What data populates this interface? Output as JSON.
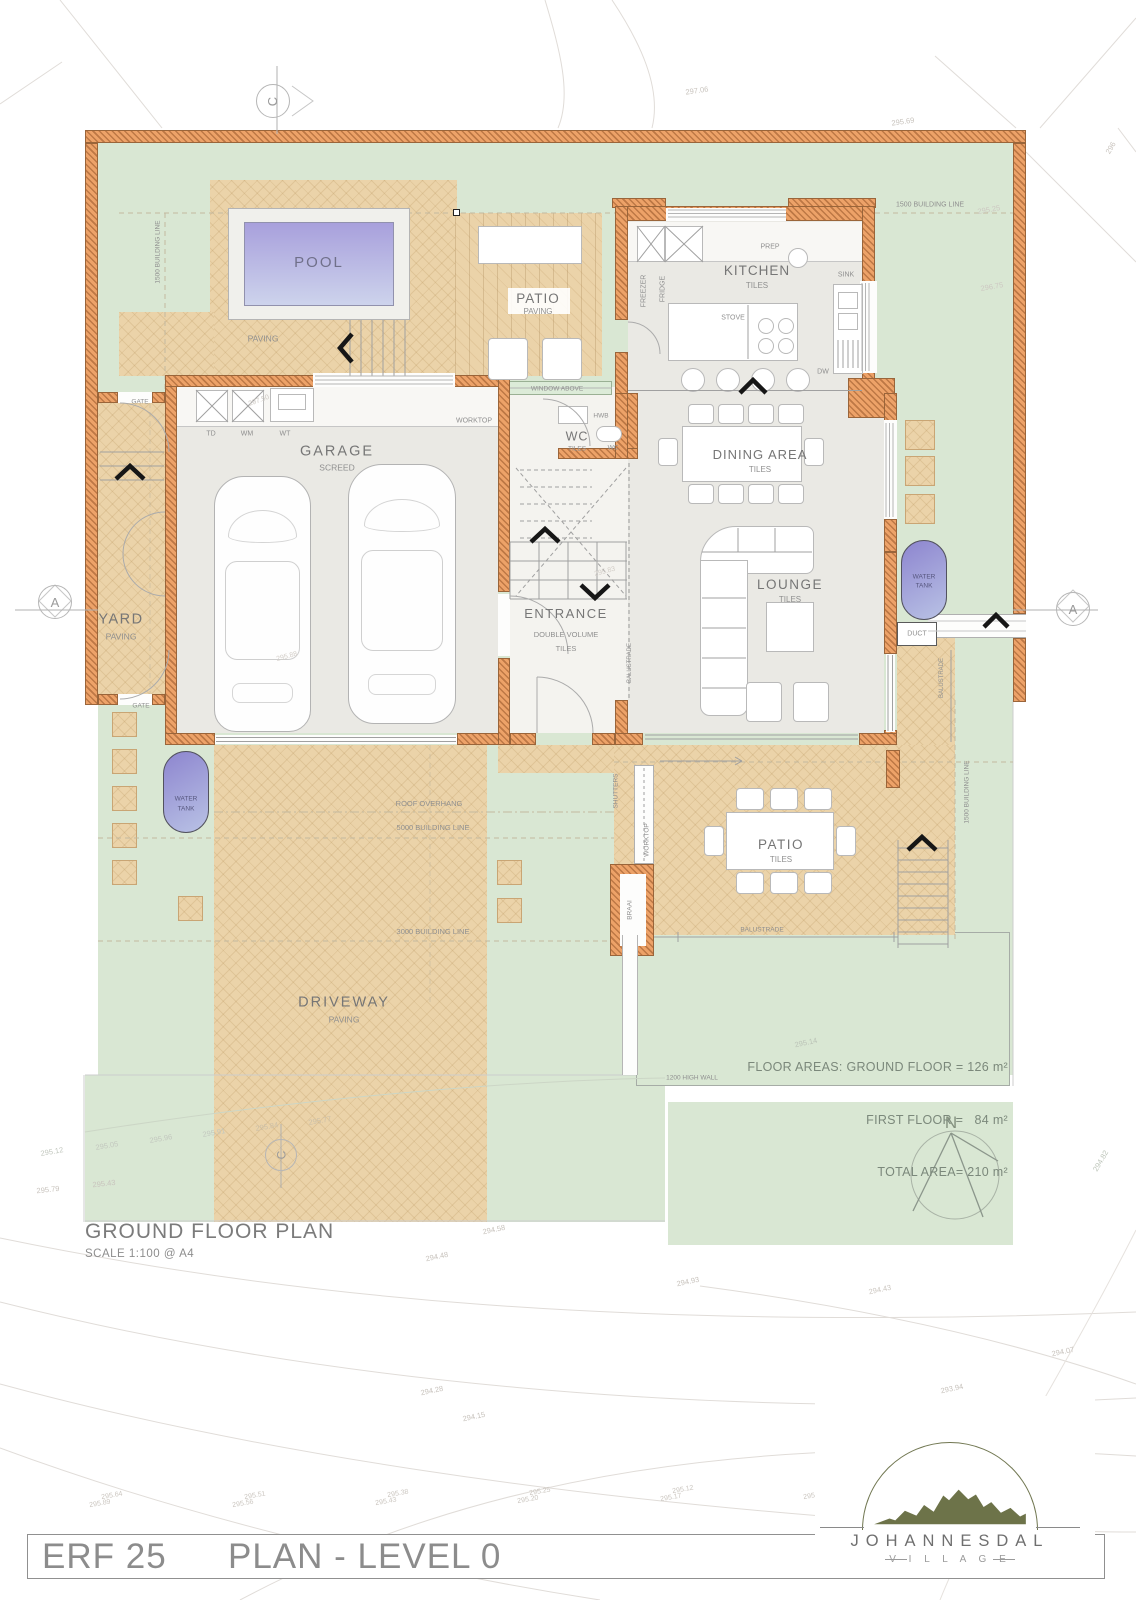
{
  "page": {
    "footer_left": "ERF 25",
    "footer_right": "PLAN - LEVEL 0",
    "plan_title": "GROUND FLOOR PLAN",
    "plan_scale": "SCALE 1:100 @ A4"
  },
  "floor_areas": {
    "line1": "FLOOR AREAS: GROUND FLOOR = 126 m²",
    "line2": "FIRST FLOOR =   84 m²",
    "line3": "TOTAL AREA= 210 m²"
  },
  "logo": {
    "name": "JOHANNESDAL",
    "sub": "V I L L A G E"
  },
  "markers": {
    "c_top": "C",
    "c_bottom": "C",
    "a_left": "A",
    "a_right": "A"
  },
  "compass": {
    "north": "N"
  },
  "colors": {
    "wall": "#eda268",
    "lawn": "#d9e7d3",
    "paving": "#ebd3a9",
    "pool": "#a8a0dc",
    "floor": "#eae9e4"
  },
  "annotations": [
    {
      "t": "POOL",
      "x": 319,
      "y": 263,
      "s": 15,
      "c": "#70708a",
      "l": 2
    },
    {
      "t": "PAVING",
      "x": 263,
      "y": 339,
      "s": 8.5
    },
    {
      "t": "PATIO",
      "x": 538,
      "y": 299,
      "s": 13.5,
      "c": "#767676",
      "l": 1
    },
    {
      "t": "PAVING",
      "x": 538,
      "y": 312,
      "s": 8
    },
    {
      "t": "KITCHEN",
      "x": 757,
      "y": 271,
      "s": 13.5,
      "c": "#767676",
      "l": 1
    },
    {
      "t": "TILES",
      "x": 757,
      "y": 286,
      "s": 8
    },
    {
      "t": "PREP",
      "x": 770,
      "y": 247,
      "s": 7
    },
    {
      "t": "FREEZER",
      "x": 644,
      "y": 291,
      "s": 7,
      "r": -90
    },
    {
      "t": "FRIDGE",
      "x": 663,
      "y": 289,
      "s": 7,
      "r": -90
    },
    {
      "t": "STOVE",
      "x": 733,
      "y": 318,
      "s": 7
    },
    {
      "t": "SINK",
      "x": 846,
      "y": 275,
      "s": 7
    },
    {
      "t": "DW",
      "x": 823,
      "y": 372,
      "s": 7
    },
    {
      "t": "1500 BUILDING LINE",
      "x": 930,
      "y": 205,
      "s": 7
    },
    {
      "t": "GARAGE",
      "x": 337,
      "y": 452,
      "s": 14.5,
      "c": "#767676",
      "l": 2
    },
    {
      "t": "SCREED",
      "x": 337,
      "y": 468,
      "s": 8.5
    },
    {
      "t": "WORKTOP",
      "x": 474,
      "y": 421,
      "s": 7
    },
    {
      "t": "TD",
      "x": 211,
      "y": 434,
      "s": 7
    },
    {
      "t": "WM",
      "x": 247,
      "y": 434,
      "s": 7
    },
    {
      "t": "WT",
      "x": 285,
      "y": 434,
      "s": 7
    },
    {
      "t": "WINDOW ABOVE",
      "x": 557,
      "y": 390,
      "s": 6.5
    },
    {
      "t": "HWB",
      "x": 601,
      "y": 417,
      "s": 6.5
    },
    {
      "t": "WC",
      "x": 577,
      "y": 437,
      "s": 12.5,
      "c": "#767676",
      "l": 1
    },
    {
      "t": "TILES",
      "x": 577,
      "y": 450,
      "s": 6.5
    },
    {
      "t": "WC",
      "x": 613,
      "y": 449,
      "s": 6.5
    },
    {
      "t": "DINING AREA",
      "x": 760,
      "y": 455,
      "s": 13,
      "c": "#767676",
      "l": 1
    },
    {
      "t": "TILES",
      "x": 760,
      "y": 470,
      "s": 8
    },
    {
      "t": "LOUNGE",
      "x": 790,
      "y": 585,
      "s": 13.5,
      "c": "#767676",
      "l": 1.5
    },
    {
      "t": "TILES",
      "x": 790,
      "y": 600,
      "s": 8
    },
    {
      "t": "ENTRANCE",
      "x": 566,
      "y": 614,
      "s": 13,
      "c": "#767676",
      "l": 1.5
    },
    {
      "t": "DOUBLE VOLUME",
      "x": 566,
      "y": 635,
      "s": 7.5
    },
    {
      "t": "TILES",
      "x": 566,
      "y": 649,
      "s": 7.5
    },
    {
      "t": "BALUSTRADE",
      "x": 630,
      "y": 663,
      "s": 6,
      "r": -90
    },
    {
      "t": "BALUSTRADE",
      "x": 942,
      "y": 678,
      "s": 6,
      "r": -90
    },
    {
      "t": "WATER",
      "x": 924,
      "y": 578,
      "s": 6.5,
      "c": "#56567e"
    },
    {
      "t": "TANK",
      "x": 924,
      "y": 587,
      "s": 6.5,
      "c": "#56567e"
    },
    {
      "t": "WATER",
      "x": 186,
      "y": 800,
      "s": 6.5,
      "c": "#56567e"
    },
    {
      "t": "TANK",
      "x": 186,
      "y": 810,
      "s": 6.5,
      "c": "#56567e"
    },
    {
      "t": "DUCT",
      "x": 917,
      "y": 634,
      "s": 7
    },
    {
      "t": "YARD",
      "x": 121,
      "y": 620,
      "s": 14.5,
      "c": "#767676",
      "l": 1.5
    },
    {
      "t": "PAVING",
      "x": 121,
      "y": 637,
      "s": 8.5
    },
    {
      "t": "GATE",
      "x": 140,
      "y": 403,
      "s": 6.5
    },
    {
      "t": "GATE",
      "x": 141,
      "y": 707,
      "s": 6.5
    },
    {
      "t": "1500 BUILDING LINE",
      "x": 159,
      "y": 252,
      "s": 6.5,
      "r": -90
    },
    {
      "t": "SHUTTERS",
      "x": 617,
      "y": 791,
      "s": 6.5,
      "r": -90
    },
    {
      "t": "WORKTOP",
      "x": 648,
      "y": 840,
      "s": 6.5,
      "r": -90
    },
    {
      "t": "BRAAI",
      "x": 631,
      "y": 910,
      "s": 6.5,
      "r": -90
    },
    {
      "t": "PATIO",
      "x": 781,
      "y": 845,
      "s": 13.5,
      "c": "#767676",
      "l": 1.5
    },
    {
      "t": "TILES",
      "x": 781,
      "y": 860,
      "s": 8
    },
    {
      "t": "BALUSTRADE",
      "x": 762,
      "y": 931,
      "s": 6.5
    },
    {
      "t": "1500 BUILDING LINE",
      "x": 968,
      "y": 792,
      "s": 6.5,
      "r": -90
    },
    {
      "t": "ROOF OVERHANG",
      "x": 429,
      "y": 804,
      "s": 7.5
    },
    {
      "t": "5000 BUILDING LINE",
      "x": 433,
      "y": 828,
      "s": 7.5
    },
    {
      "t": "3000 BUILDING LINE",
      "x": 433,
      "y": 932,
      "s": 7.5
    },
    {
      "t": "DRIVEWAY",
      "x": 344,
      "y": 1003,
      "s": 14.5,
      "c": "#767676",
      "l": 2
    },
    {
      "t": "PAVING",
      "x": 344,
      "y": 1020,
      "s": 8.5
    },
    {
      "t": "1200 HIGH WALL",
      "x": 692,
      "y": 1079,
      "s": 6.5
    },
    {
      "t": "N",
      "x": 951,
      "y": 1123,
      "s": 17,
      "c": "#84917f"
    },
    {
      "t": "297.06",
      "x": 697,
      "y": 91,
      "s": 7.5,
      "c": "#c8c3bd",
      "r": -8
    },
    {
      "t": "295.69",
      "x": 903,
      "y": 122,
      "s": 7.5,
      "c": "#c8c3bd",
      "r": -8
    },
    {
      "t": "295.25",
      "x": 989,
      "y": 210,
      "s": 7.5,
      "c": "#cdc8c2",
      "r": -10
    },
    {
      "t": "296.75",
      "x": 992,
      "y": 287,
      "s": 7.5,
      "c": "#cdc8c2",
      "r": -10
    },
    {
      "t": "296",
      "x": 1111,
      "y": 148,
      "s": 7.5,
      "c": "#c8c3bd",
      "r": -60
    },
    {
      "t": "297.50",
      "x": 259,
      "y": 401,
      "s": 7,
      "c": "#cdc8c2",
      "r": -20
    },
    {
      "t": "295.88",
      "x": 287,
      "y": 657,
      "s": 7,
      "c": "#d2cdc7",
      "r": -15
    },
    {
      "t": "295.83",
      "x": 605,
      "y": 572,
      "s": 7,
      "c": "#d2cdc7",
      "r": -15
    },
    {
      "t": "295.14",
      "x": 806,
      "y": 1043,
      "s": 7.5,
      "c": "#bcc4b8",
      "r": -12
    },
    {
      "t": "295.12",
      "x": 52,
      "y": 1152,
      "s": 7.5,
      "c": "#c3c8bf",
      "r": -10
    },
    {
      "t": "295.05",
      "x": 107,
      "y": 1146,
      "s": 7.5,
      "c": "#c3c8bf",
      "r": -10
    },
    {
      "t": "295.96",
      "x": 161,
      "y": 1139,
      "s": 7.5,
      "c": "#c3c8bf",
      "r": -10
    },
    {
      "t": "295.91",
      "x": 214,
      "y": 1133,
      "s": 7.5,
      "c": "#c3c8bf",
      "r": -10
    },
    {
      "t": "295.84",
      "x": 267,
      "y": 1127,
      "s": 7.5,
      "c": "#cbbfa8",
      "r": -10
    },
    {
      "t": "295.77",
      "x": 320,
      "y": 1121,
      "s": 7.5,
      "c": "#cbbfa8",
      "r": -10
    },
    {
      "t": "295.79",
      "x": 48,
      "y": 1190,
      "s": 7.5,
      "c": "#c8c3bd",
      "r": -6
    },
    {
      "t": "295.43",
      "x": 104,
      "y": 1184,
      "s": 7.5,
      "c": "#c8c3bd",
      "r": -6
    },
    {
      "t": "294.58",
      "x": 494,
      "y": 1230,
      "s": 7.5,
      "c": "#c8c3bd",
      "r": -12
    },
    {
      "t": "294.48",
      "x": 437,
      "y": 1257,
      "s": 7.5,
      "c": "#c8c3bd",
      "r": -12
    },
    {
      "t": "294.93",
      "x": 688,
      "y": 1282,
      "s": 7.5,
      "c": "#c8c3bd",
      "r": -12
    },
    {
      "t": "294.43",
      "x": 880,
      "y": 1290,
      "s": 7.5,
      "c": "#cdc8c2",
      "r": -12
    },
    {
      "t": "294.07",
      "x": 1063,
      "y": 1352,
      "s": 7.5,
      "c": "#c8c3bd",
      "r": -12
    },
    {
      "t": "293.94",
      "x": 952,
      "y": 1389,
      "s": 7.5,
      "c": "#c8c3bd",
      "r": -12
    },
    {
      "t": "293.81",
      "x": 899,
      "y": 1446,
      "s": 7.5,
      "c": "#c8c3bd",
      "r": -25
    },
    {
      "t": "293.95",
      "x": 1015,
      "y": 1460,
      "s": 7.5,
      "c": "#cdc8c2",
      "r": -25
    },
    {
      "t": "294.28",
      "x": 432,
      "y": 1391,
      "s": 7.5,
      "c": "#c8c3bd",
      "r": -12
    },
    {
      "t": "294.15",
      "x": 474,
      "y": 1417,
      "s": 7.5,
      "c": "#c8c3bd",
      "r": -12
    },
    {
      "t": "294.82",
      "x": 1101,
      "y": 1161,
      "s": 7.5,
      "c": "#bcc4b8",
      "r": -60
    },
    {
      "t": "295.64",
      "x": 112,
      "y": 1496,
      "s": 7,
      "c": "#ccc7c1",
      "r": -10
    },
    {
      "t": "295.89",
      "x": 100,
      "y": 1504,
      "s": 7,
      "c": "#ccc7c1",
      "r": -10
    },
    {
      "t": "295.51",
      "x": 255,
      "y": 1496,
      "s": 7,
      "c": "#ccc7c1",
      "r": -10
    },
    {
      "t": "295.56",
      "x": 243,
      "y": 1504,
      "s": 7,
      "c": "#ccc7c1",
      "r": -10
    },
    {
      "t": "295.38",
      "x": 398,
      "y": 1494,
      "s": 7,
      "c": "#ccc7c1",
      "r": -10
    },
    {
      "t": "295.43",
      "x": 386,
      "y": 1502,
      "s": 7,
      "c": "#ccc7c1",
      "r": -10
    },
    {
      "t": "295.25",
      "x": 540,
      "y": 1492,
      "s": 7,
      "c": "#ccc7c1",
      "r": -10
    },
    {
      "t": "295.20",
      "x": 528,
      "y": 1500,
      "s": 7,
      "c": "#ccc7c1",
      "r": -10
    },
    {
      "t": "295.12",
      "x": 683,
      "y": 1490,
      "s": 7,
      "c": "#ccc7c1",
      "r": -10
    },
    {
      "t": "295.17",
      "x": 671,
      "y": 1498,
      "s": 7,
      "c": "#ccc7c1",
      "r": -10
    },
    {
      "t": "295.00",
      "x": 826,
      "y": 1488,
      "s": 7,
      "c": "#ccc7c1",
      "r": -10
    },
    {
      "t": "295.05",
      "x": 814,
      "y": 1496,
      "s": 7,
      "c": "#ccc7c1",
      "r": -10
    },
    {
      "t": "294.85",
      "x": 943,
      "y": 1485,
      "s": 7,
      "c": "#ccc7c1",
      "r": -10
    },
    {
      "t": "294.90",
      "x": 955,
      "y": 1493,
      "s": 7,
      "c": "#ccc7c1",
      "r": -10
    },
    {
      "t": "294.74",
      "x": 1078,
      "y": 1482,
      "s": 7,
      "c": "#ccc7c1",
      "r": -10
    },
    {
      "t": "294.79",
      "x": 1066,
      "y": 1490,
      "s": 7,
      "c": "#ccc7c1",
      "r": -10
    }
  ]
}
